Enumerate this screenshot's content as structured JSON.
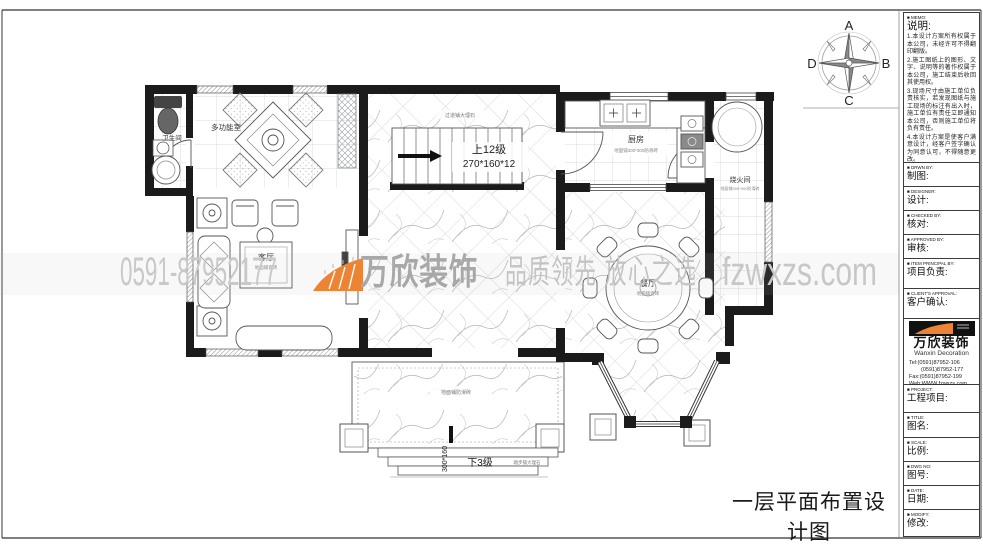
{
  "sheet": {
    "drawing_title": "一层平面布置设计图"
  },
  "watermark": {
    "phone": "0591-87952177",
    "brand": "万欣装饰",
    "slogan": "品质领先 放心之选",
    "website": "fzwxzs.com",
    "accent_color": "#ed8434",
    "text_color": "#c6c6c6"
  },
  "compass": {
    "n": "A",
    "e": "B",
    "s": "C",
    "w": "D"
  },
  "plan": {
    "rooms": {
      "bathroom": {
        "name": "卫生间"
      },
      "multi": {
        "name": "多功能室"
      },
      "living": {
        "name": "客厅",
        "note": "地面铺瓷砖"
      },
      "kitchen": {
        "name": "厨房",
        "note": "地面铺300*300防滑砖"
      },
      "boiler": {
        "name": "烧火间",
        "note": "地面铺300*300防滑砖"
      },
      "dining": {
        "name": "餐厅",
        "note": "地面铺瓷砖"
      }
    },
    "corridor_note": "过道铺大理石",
    "terrace_note": "地面铺防滑砖",
    "stairs": {
      "label": "上12级",
      "dims": "270*160*12"
    },
    "steps": {
      "label": "下3级",
      "dims": "300*160",
      "note": "踏步铺大理石"
    }
  },
  "titleblock": {
    "memo": {
      "tag": "MEMO:",
      "label": "说明:",
      "items": [
        "1.本设计方案所有权属于本公司，未经许可不得翻印翻版。",
        "2.施工图纸上的图形、文字、说明等的著作权属于本公司，施工结束后收回其使用权。",
        "3.现场尺寸由施工单位负责核实，若发现图纸与施工现场的标注有出入时，施工单位有责任立即通知本公司，否则施工单位将负有责任。",
        "4.本设计方案是使客户满意设计，经客户签字确认为同意认可，不得随意更改。"
      ]
    },
    "fields": [
      {
        "tag": "DRWN BY:",
        "label": "制图:"
      },
      {
        "tag": "DESIGNER:",
        "label": "设计:"
      },
      {
        "tag": "CHECKED BY:",
        "label": "核对:"
      },
      {
        "tag": "APPROVED BY:",
        "label": "审核:"
      },
      {
        "tag": "ITEM PRINCIPAL BY:",
        "label": "项目负责:"
      },
      {
        "tag": "CLIENT'S APPROVAL:",
        "label": "客户确认:"
      }
    ],
    "company": {
      "name": "万欣装饰",
      "name_en": "Wanxin Decoration",
      "tel1": "Tel:(0591)87952-106",
      "tel2": "(0591)87952-177",
      "fax": "Fax:(0591)87952-199",
      "web": "Web:WWW.fzwxzs.com"
    },
    "fields2": [
      {
        "tag": "PROJECT:",
        "label": "工程项目:"
      },
      {
        "tag": "TITLE:",
        "label": "图名:"
      },
      {
        "tag": "SCALE:",
        "label": "比例:"
      },
      {
        "tag": "DWG NO:",
        "label": "图号:"
      },
      {
        "tag": "DATE:",
        "label": "日期:"
      },
      {
        "tag": "MODIFY:",
        "label": "修改:"
      }
    ]
  }
}
